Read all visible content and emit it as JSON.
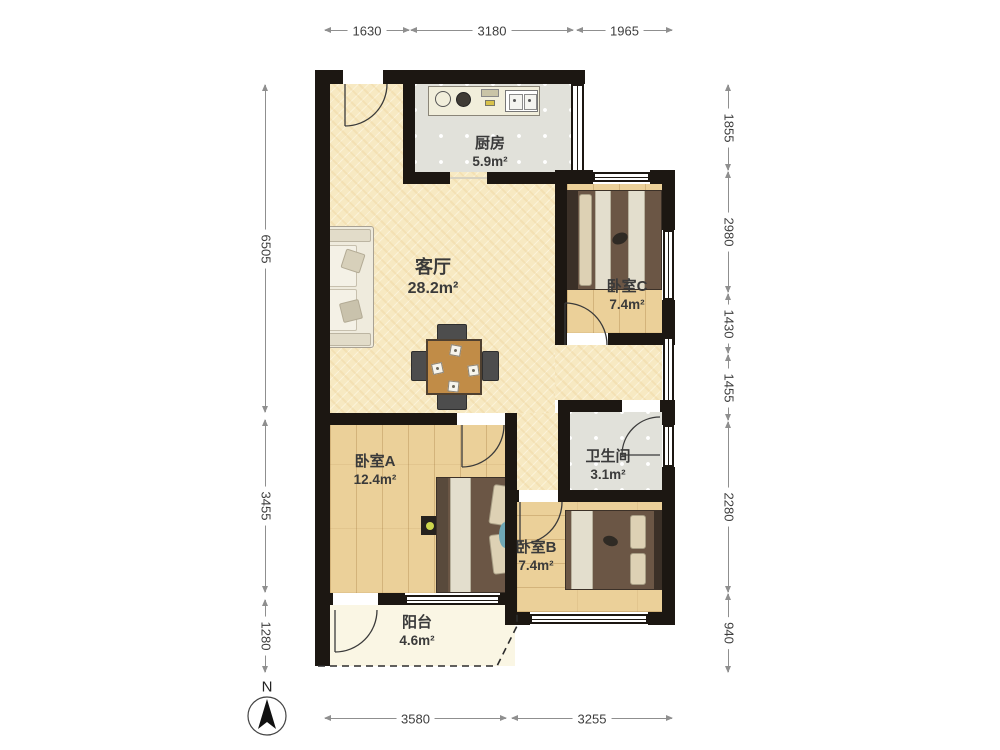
{
  "plan_title": "apartment-floor-plan",
  "compass": {
    "north_label": "N"
  },
  "rooms": {
    "kitchen": {
      "name": "厨房",
      "area": "5.9m²"
    },
    "living": {
      "name": "客厅",
      "area": "28.2m²"
    },
    "bedroom_c": {
      "name": "卧室C",
      "area": "7.4m²"
    },
    "bathroom": {
      "name": "卫生间",
      "area": "3.1m²"
    },
    "bedroom_a": {
      "name": "卧室A",
      "area": "12.4m²"
    },
    "bedroom_b": {
      "name": "卧室B",
      "area": "7.4m²"
    },
    "balcony": {
      "name": "阳台",
      "area": "4.6m²"
    }
  },
  "dimensions": {
    "top": [
      "1630",
      "3180",
      "1965"
    ],
    "left": [
      "6505",
      "3455",
      "1280"
    ],
    "right": [
      "1855",
      "2980",
      "1430",
      "1455",
      "2280",
      "940"
    ],
    "bottom": [
      "3580",
      "3255"
    ]
  },
  "colors": {
    "wall": "#1c1712",
    "living_floor": "#f7e9c2",
    "wood_floor": "#ebd099",
    "tile_floor": "#e1e1da",
    "balcony_floor": "#faf6e4"
  }
}
